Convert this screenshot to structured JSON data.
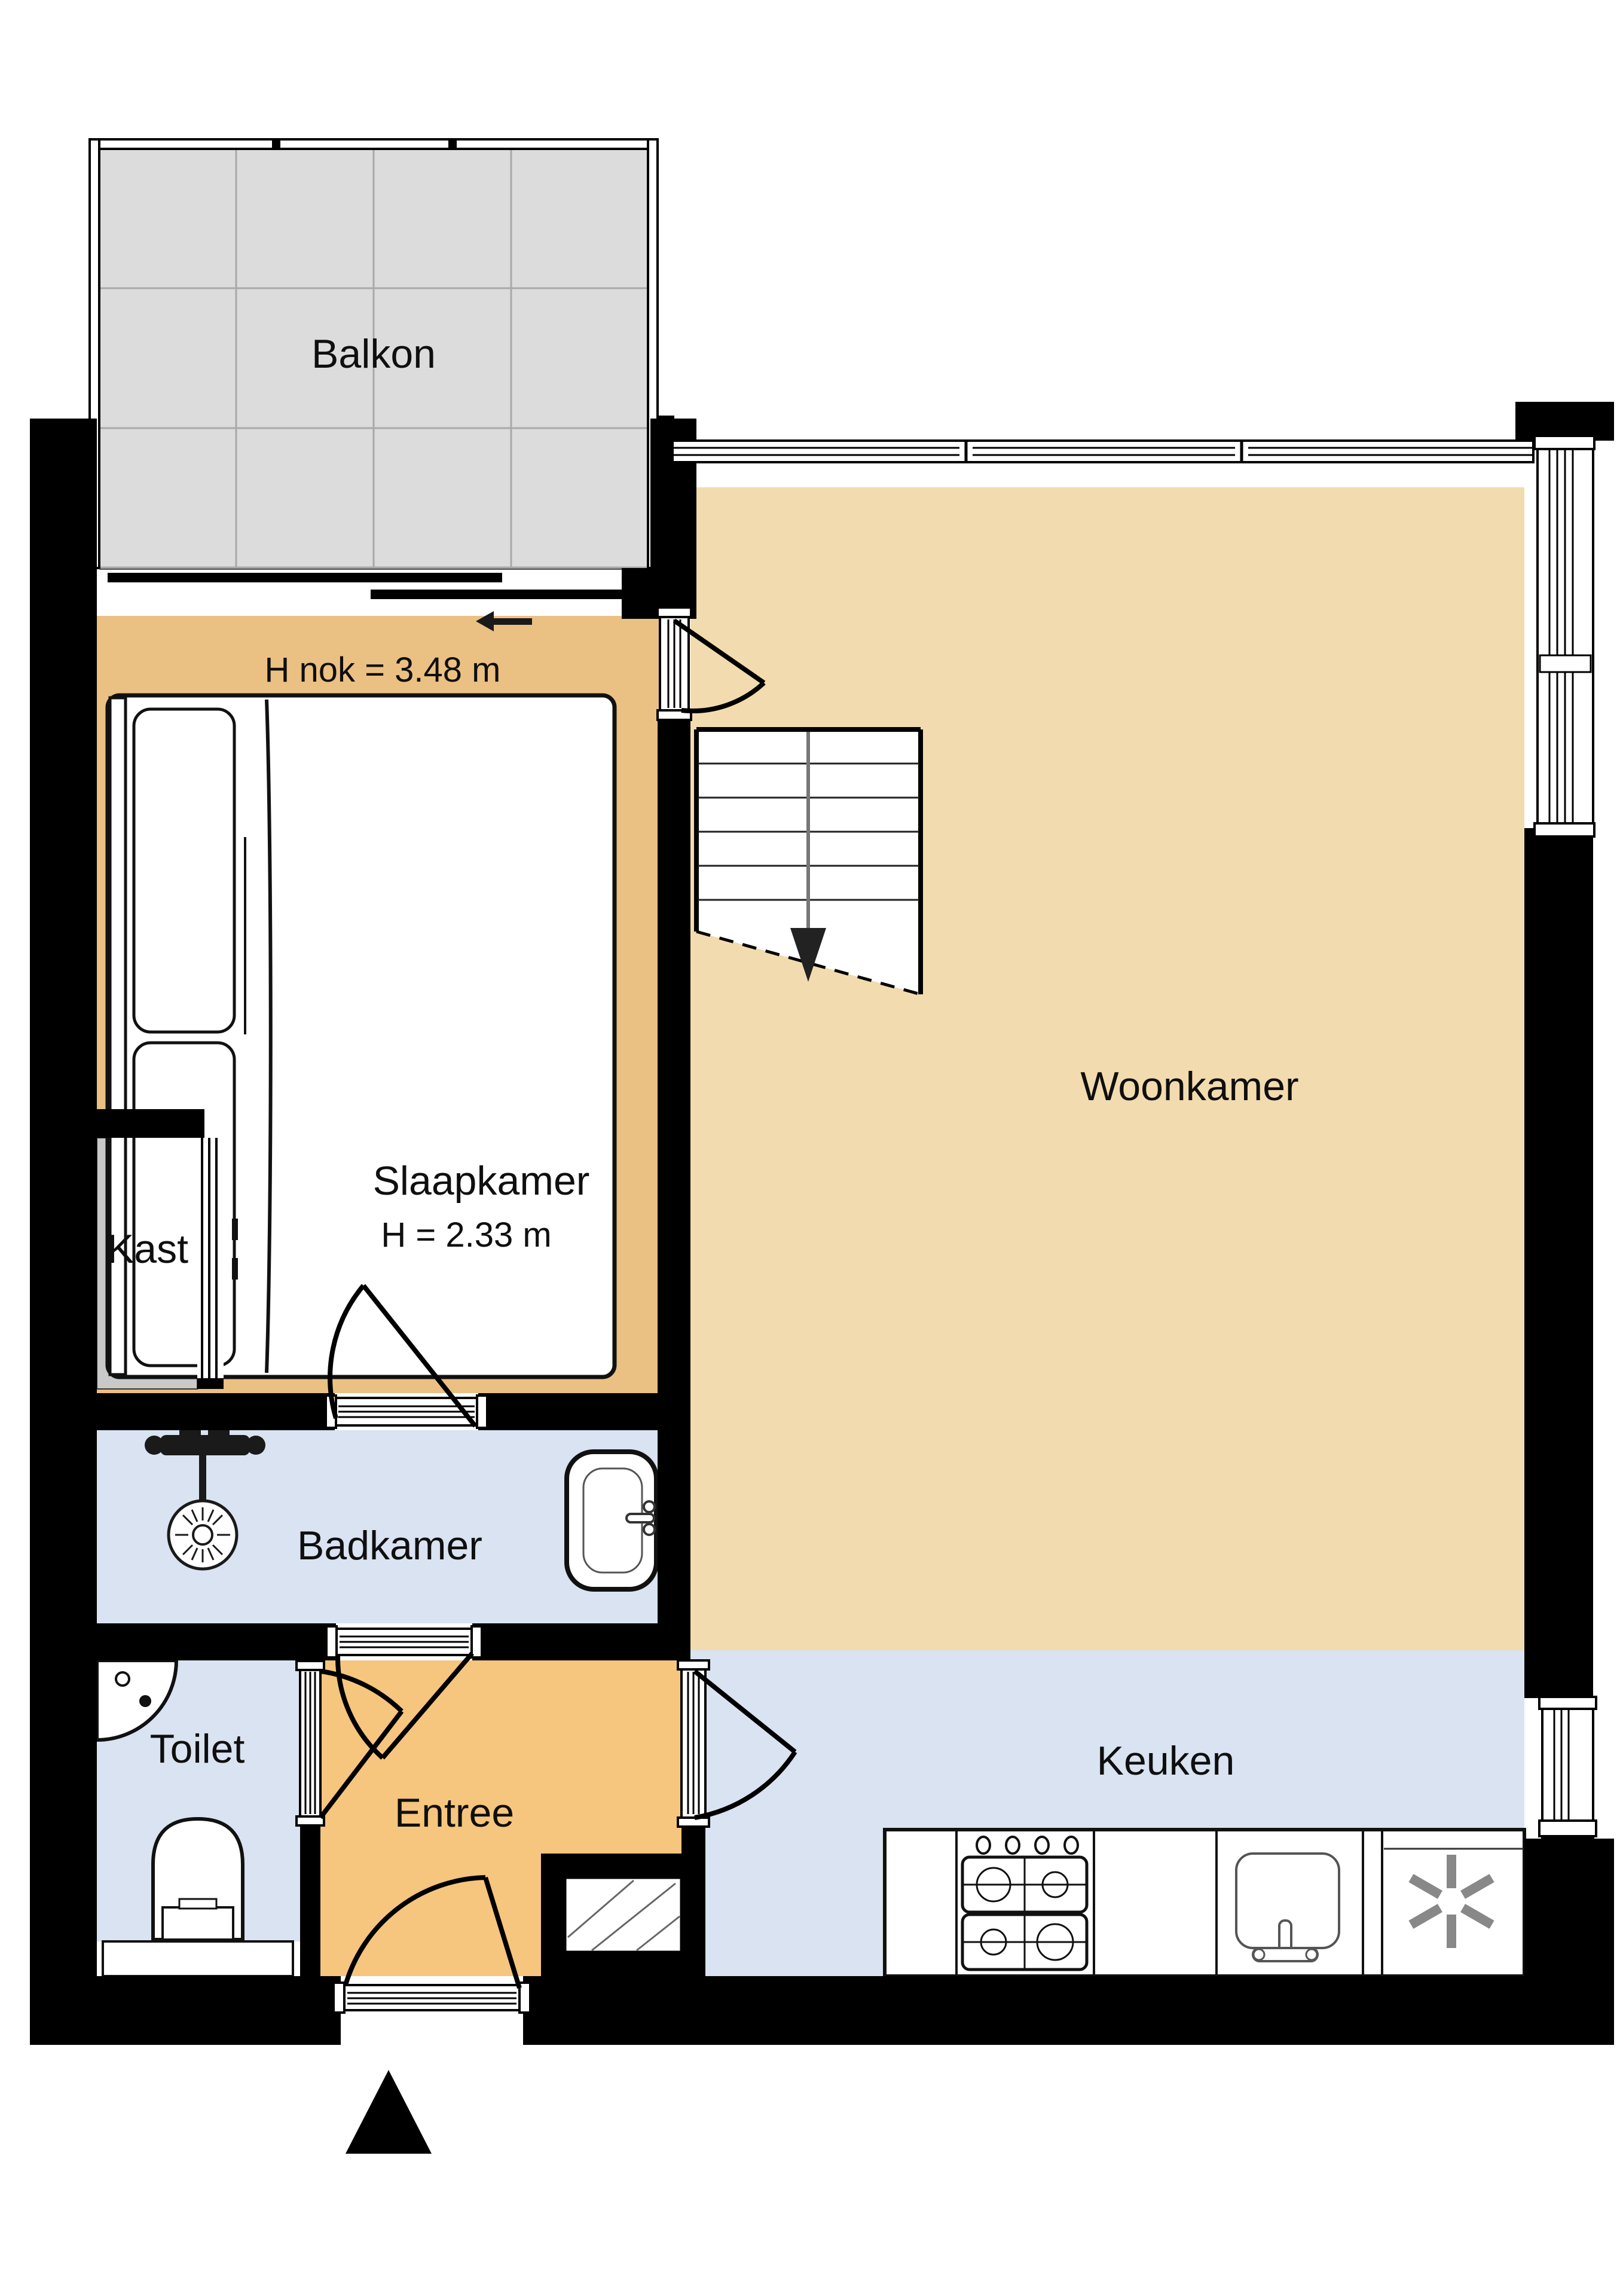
{
  "floorplan": {
    "type": "apartment-floorplan",
    "labels": {
      "balkon": "Balkon",
      "ridge_height": "H nok = 3.48 m",
      "slaapkamer": "Slaapkamer",
      "slaapkamer_height": "H = 2.33 m",
      "kast": "Kast",
      "woonkamer": "Woonkamer",
      "badkamer": "Badkamer",
      "toilet": "Toilet",
      "entree": "Entree",
      "keuken": "Keuken"
    },
    "colors": {
      "bedroom_floor": "#ebc083",
      "living_floor": "#f2dbae",
      "entry_floor": "#f6c57e",
      "wet_room_floor": "#d9e3f1",
      "closet_fill": "#c9c9c9",
      "balcony_tile": "#dcdcdc",
      "wall": "#000000"
    }
  }
}
